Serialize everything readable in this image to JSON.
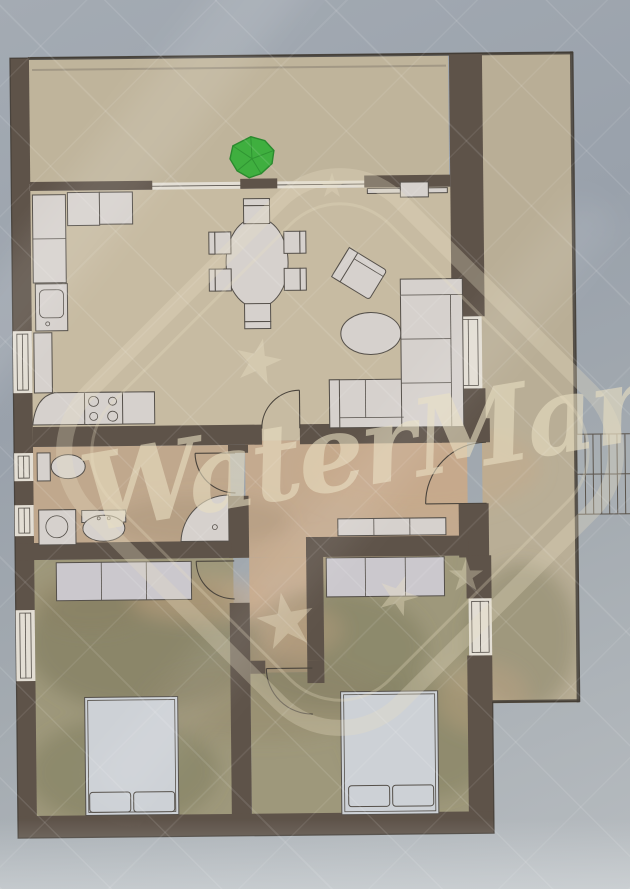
{
  "watermark": {
    "text": "WaterMark"
  },
  "symbols": {
    "plant": "potted-plant-plan-symbol"
  },
  "palette": {
    "bg_top": "#a4abb3",
    "bg_mid": "#99a1ab",
    "bg_bottom": "#b7bcc0",
    "wall": "#5e5349",
    "wall_edge": "#39332c",
    "floor_balcony": "#bfb49b",
    "floor_living": "#c7bba2",
    "floor_hall": "#c4aa8f",
    "floor_bath": "#c0a88d",
    "floor_bedroom": "#9e987b",
    "floor_terrace": "#b9ae96",
    "window_fill": "#e3ded4",
    "furniture_fill": "#d6d1cd",
    "furniture_stroke": "#55504a",
    "bed_fill": "#cdd1d6",
    "wardrobe_fill": "#cbc8cd",
    "plant_green": "#3faf3f",
    "plant_dark": "#2a8a2e",
    "watermark_cream": "#e9dfc2",
    "stairs_line": "#5b544c",
    "mottle_olive": "#6e6c50",
    "mottle_brown": "#8a7a5e",
    "mottle_tan": "#c9a886"
  }
}
